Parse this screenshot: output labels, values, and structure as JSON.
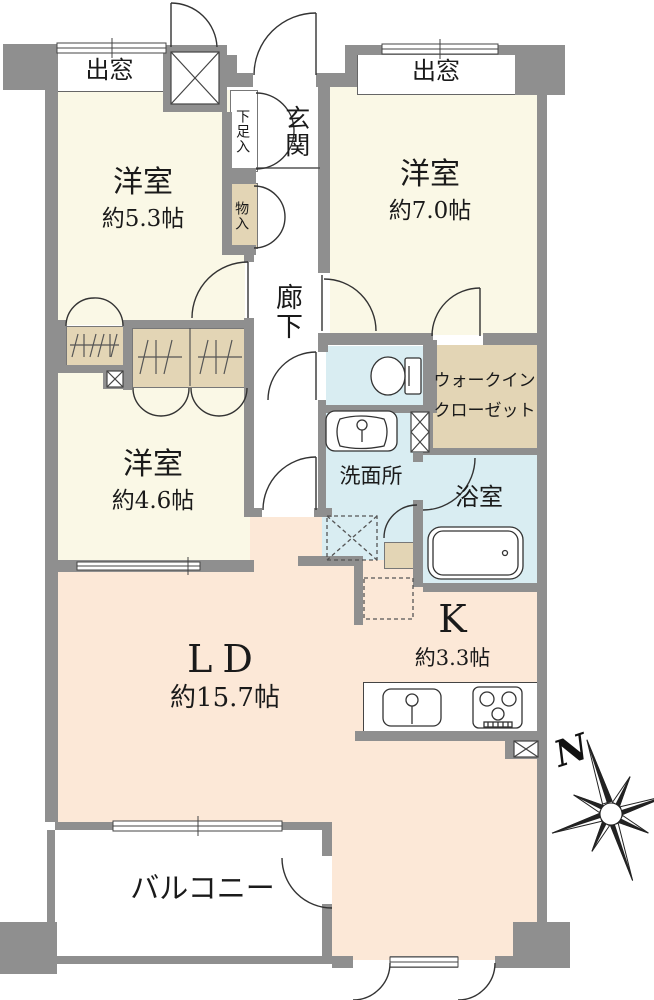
{
  "floorplan": {
    "labels": {
      "bay_left": "出窓",
      "bay_right": "出窓",
      "bedroom53_name": "洋室",
      "bedroom53_size": "約5.3帖",
      "bedroom70_name": "洋室",
      "bedroom70_size": "約7.0帖",
      "bedroom46_name": "洋室",
      "bedroom46_size": "約4.6帖",
      "entrance": "玄関",
      "shoe_cabinet": "下足入",
      "storage": "物入",
      "hallway": "廊下",
      "walk_in_closet_line1": "ウォークイン",
      "walk_in_closet_line2": "クローゼット",
      "washroom": "洗面所",
      "bathroom": "浴室",
      "living_dining_name": "LD",
      "living_dining_size": "約15.7帖",
      "kitchen_name": "K",
      "kitchen_size": "約3.3帖",
      "balcony": "バルコニー",
      "compass_north": "N"
    },
    "colors": {
      "wall": "#8f8f8f",
      "western_room": "#faf8e6",
      "living_dining": "#fce8d7",
      "wet_area": "#d9edf2",
      "closet": "#e3d5b5",
      "line": "#333333"
    }
  }
}
